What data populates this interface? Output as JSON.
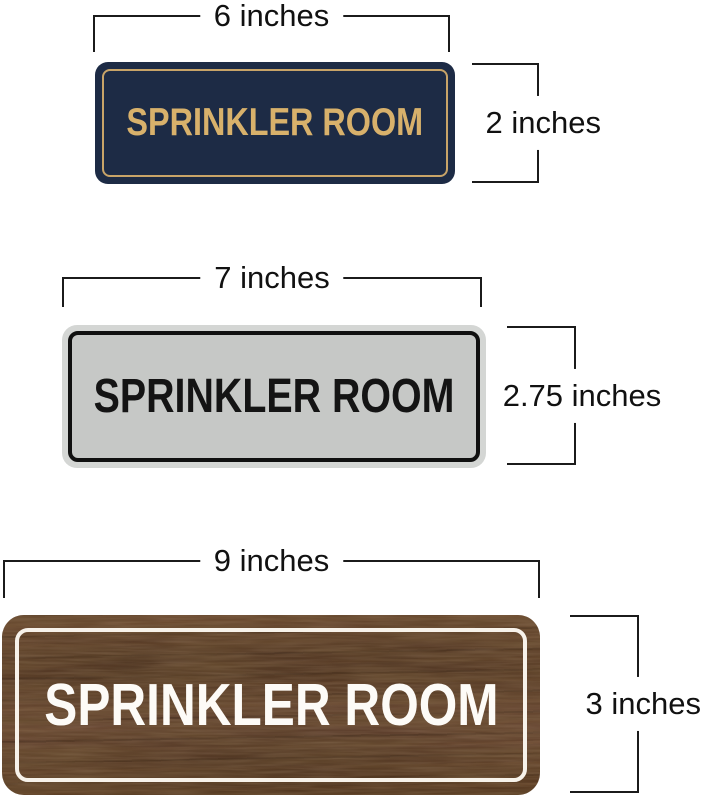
{
  "image_type": "product-size-diagram",
  "dimension_annotation_color": "#1b1b1b",
  "page_background": "#ffffff",
  "signs": [
    {
      "id": "navy-gold-sign",
      "text": "SPRINKLER ROOM",
      "width_label": "6 inches",
      "height_label": "2 inches",
      "colors": {
        "background": "#1d2b45",
        "inner_border": "#c8a468",
        "text": "#d8b16b"
      }
    },
    {
      "id": "silver-black-sign",
      "text": "SPRINKLER ROOM",
      "width_label": "7 inches",
      "height_label": "2.75 inches",
      "colors": {
        "background": "#c6c8c6",
        "outer_rim": "#d4d6d4",
        "inner_border": "#101010",
        "text": "#141414"
      }
    },
    {
      "id": "walnut-wood-sign",
      "text": "SPRINKLER ROOM",
      "width_label": "9 inches",
      "height_label": "3 inches",
      "colors": {
        "background": "#5d3f29",
        "wood_dark_streak": "#3a2417",
        "wood_light_streak": "#7b5a41",
        "inner_border": "#f7f2ea",
        "text": "#fdfbf7"
      }
    }
  ]
}
